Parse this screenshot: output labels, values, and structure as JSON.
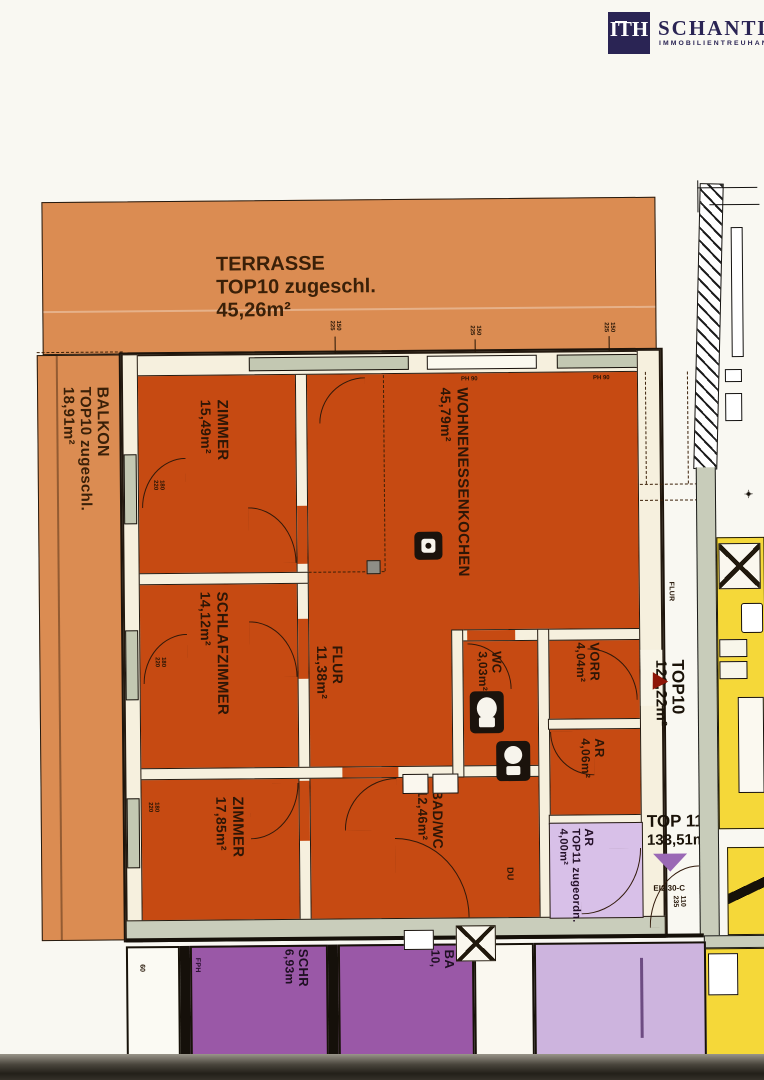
{
  "logo": {
    "initials": "ITH",
    "name": "SCHANTL",
    "subtitle": "IMMOBILIENTREUHAND",
    "navy": "#2a2454"
  },
  "rooms": {
    "terrasse": {
      "name": "TERRASSE",
      "note": "TOP10 zugeschl.",
      "area": "45,26m²"
    },
    "balkon": {
      "name": "BALKON",
      "note": "TOP10 zugeschl.",
      "area": "18,91m²"
    },
    "zimmer1": {
      "name": "ZIMMER",
      "area": "15,49m²"
    },
    "wohnkueche": {
      "name": "WOHNENESSENKOCHEN",
      "area": "45,79m²"
    },
    "schlafzimmer": {
      "name": "SCHLAFZIMMER",
      "area": "14,12m²"
    },
    "flur": {
      "name": "FLUR",
      "area": "11,38m²"
    },
    "wc": {
      "name": "WC",
      "area": "3,03m²"
    },
    "vorraum": {
      "name": "VORR",
      "area": "4,04m²"
    },
    "abstellraum": {
      "name": "AR",
      "area": "4,06m²"
    },
    "zimmer2": {
      "name": "ZIMMER",
      "area": "17,85m²"
    },
    "badwc": {
      "name": "BAD/WC",
      "area": "12,46m²",
      "shower": "DU"
    },
    "ar_top11": {
      "name": "AR",
      "note": "TOP11 zugeordn.",
      "area": "4,00m²"
    },
    "schrank": {
      "name": "SCHR",
      "area": "6,93m"
    },
    "bad_unten": {
      "name": "BA",
      "area": "10,"
    },
    "flur_allg": {
      "name": "FLUR"
    }
  },
  "units": {
    "top10": {
      "name": "TOP10",
      "area": "129,22m²"
    },
    "top11": {
      "name": "TOP 11",
      "area": "133,51m²"
    }
  },
  "annotations": {
    "win_top_w": "150",
    "win_top_h": "225",
    "ph": "PH 90",
    "win_left_w": "180",
    "win_left_h": "220",
    "door_class": "EI2 30-C",
    "door_w": "110",
    "door_h": "235",
    "b60": "60",
    "fph": "FPH",
    "star": "✦"
  },
  "colors": {
    "terrace_tan": "#db8c52",
    "apartment_orange": "#c64a12",
    "wall_cream": "#f6f0de",
    "purple_dark": "#9a58a7",
    "purple_light": "#d8c0e8",
    "corridor_lilac": "#cdb4de",
    "yellow_unit": "#f5d839",
    "grey_green": "#c8ccba",
    "logo_navy": "#2a2454"
  }
}
